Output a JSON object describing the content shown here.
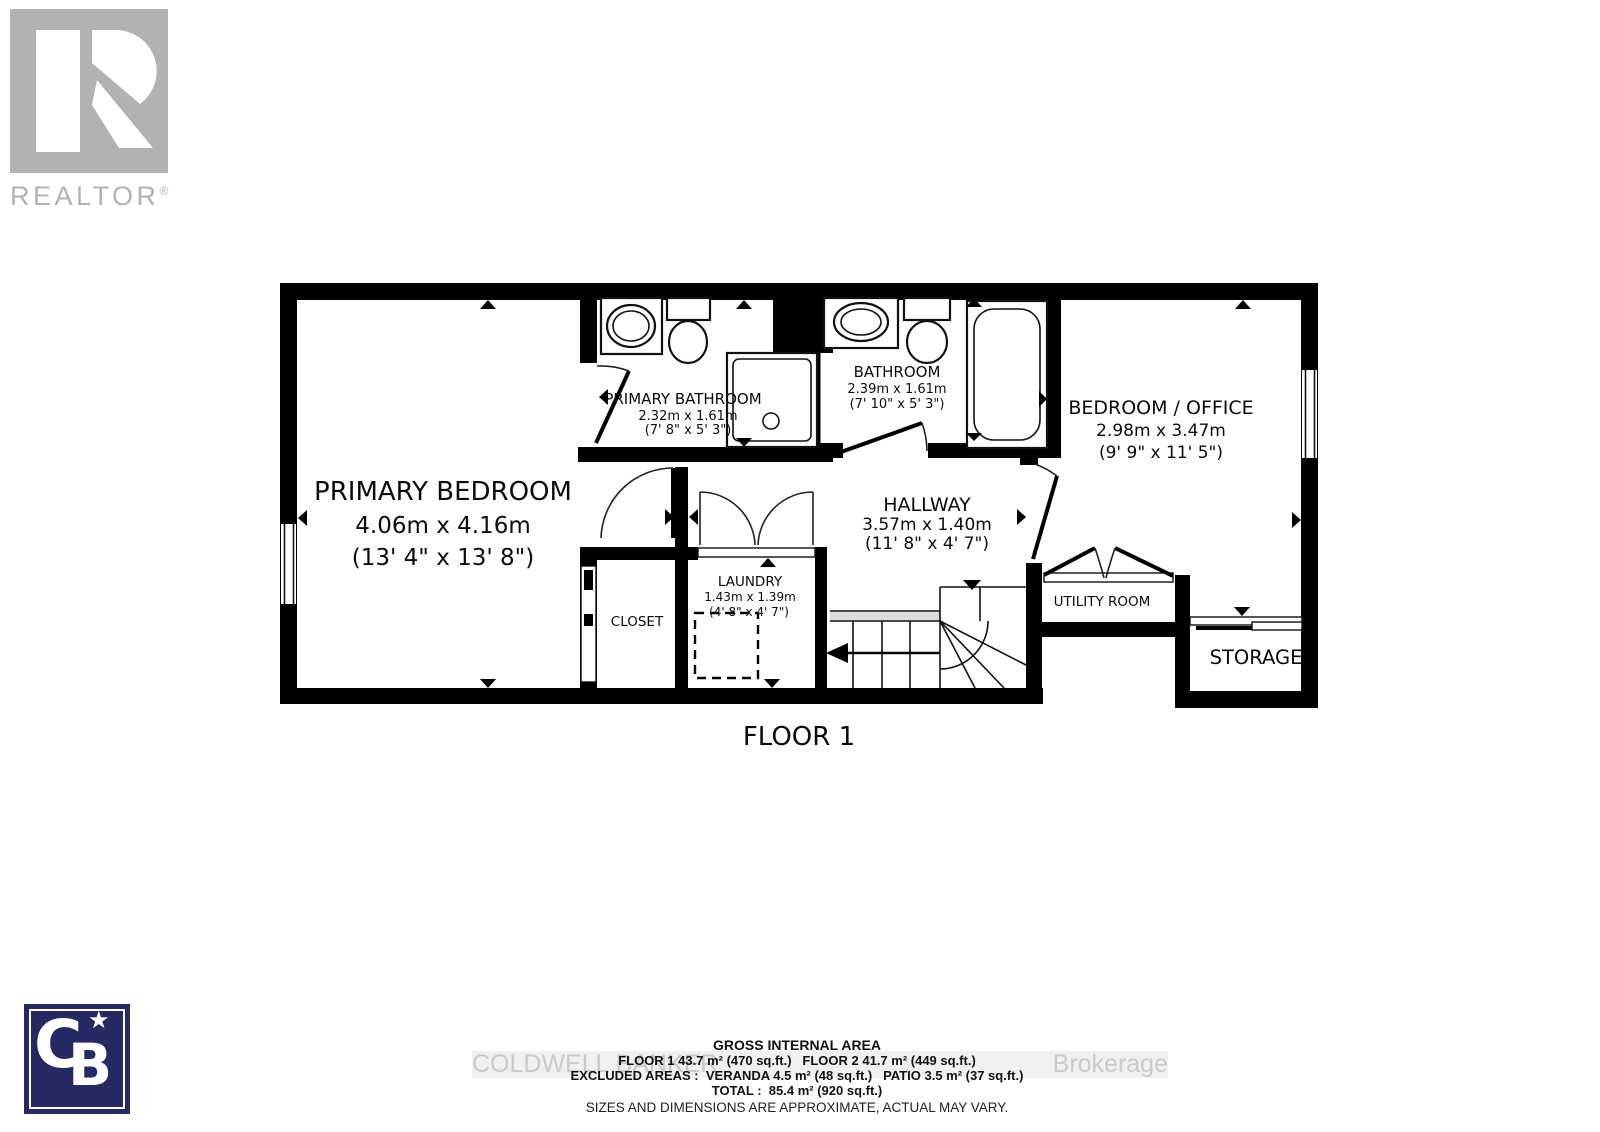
{
  "branding": {
    "realtor_wordmark": "REALTOR",
    "registered_mark": "®",
    "cb_letter_c": "C",
    "cb_letter_b": "B",
    "cb_star": "★"
  },
  "watermark": {
    "left": "COLDWELL BANKER",
    "right": "Brokerage"
  },
  "plan": {
    "floor_label": "FLOOR 1",
    "rooms": {
      "primary_bedroom": {
        "name": "PRIMARY BEDROOM",
        "metric": "4.06m x 4.16m",
        "imperial": "(13' 4\" x 13' 8\")"
      },
      "primary_bathroom": {
        "name": "PRIMARY BATHROOM",
        "metric": "2.32m x 1.61m",
        "imperial": "(7' 8\" x 5' 3\")"
      },
      "bathroom": {
        "name": "BATHROOM",
        "metric": "2.39m x 1.61m",
        "imperial": "(7' 10\" x 5' 3\")"
      },
      "bedroom_office": {
        "name": "BEDROOM / OFFICE",
        "metric": "2.98m x 3.47m",
        "imperial": "(9' 9\" x 11' 5\")"
      },
      "hallway": {
        "name": "HALLWAY",
        "metric": "3.57m x 1.40m",
        "imperial": "(11' 8\" x 4' 7\")"
      },
      "laundry": {
        "name": "LAUNDRY",
        "metric": "1.43m x 1.39m",
        "imperial": "(4' 8\" x 4' 7\")"
      },
      "closet": {
        "name": "CLOSET"
      },
      "utility_room": {
        "name": "UTILITY ROOM"
      },
      "storage": {
        "name": "STORAGE"
      }
    }
  },
  "summary": {
    "title": "GROSS INTERNAL AREA",
    "floors_line": "FLOOR 1 43.7 m² (470 sq.ft.)   FLOOR 2 41.7 m² (449 sq.ft.)",
    "excluded_line": "EXCLUDED AREAS :  VERANDA 4.5 m² (48 sq.ft.)   PATIO 3.5 m² (37 sq.ft.)",
    "total_line": "TOTAL :  85.4 m² (920 sq.ft.)",
    "disclaimer": "SIZES AND DIMENSIONS ARE APPROXIMATE, ACTUAL MAY VARY."
  },
  "colors": {
    "wall_black": "#000000",
    "realtor_gray": "#b2b2b2",
    "cb_navy": "#252a63",
    "watermark_gray": "#c9c9c9"
  }
}
